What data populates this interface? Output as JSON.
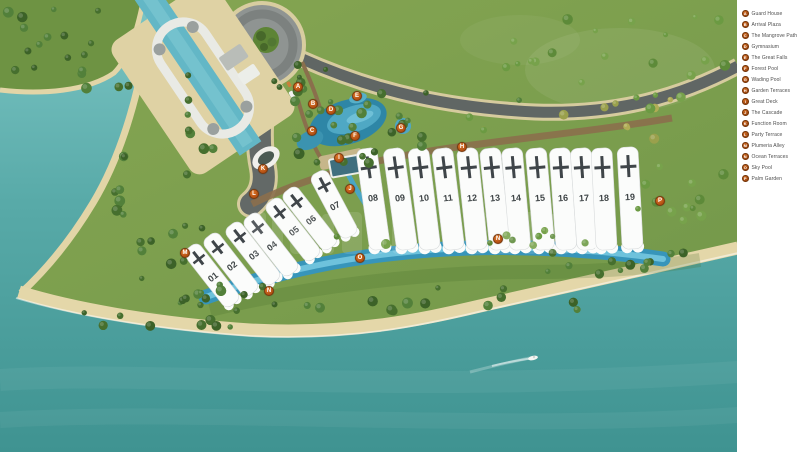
{
  "legend": {
    "badge_color": "#c05a1a",
    "items": [
      {
        "key": "A",
        "label": "Guard House"
      },
      {
        "key": "B",
        "label": "Arrival Plaza"
      },
      {
        "key": "C",
        "label": "The Mangrove Path"
      },
      {
        "key": "D",
        "label": "Gymnasium"
      },
      {
        "key": "E",
        "label": "The Great Falls"
      },
      {
        "key": "F",
        "label": "Forest Pool"
      },
      {
        "key": "G",
        "label": "Wading Pool"
      },
      {
        "key": "H",
        "label": "Garden Terraces"
      },
      {
        "key": "I",
        "label": "Great Deck"
      },
      {
        "key": "J",
        "label": "The Cascade"
      },
      {
        "key": "K",
        "label": "Function Room"
      },
      {
        "key": "L",
        "label": "Party Terrace"
      },
      {
        "key": "M",
        "label": "Plumeria Alley"
      },
      {
        "key": "N",
        "label": "Ocean Terraces"
      },
      {
        "key": "O",
        "label": "Sky Pool"
      },
      {
        "key": "P",
        "label": "Palm Garden"
      }
    ]
  },
  "map": {
    "marker_color": "#c05a1a",
    "markers": [
      {
        "key": "A",
        "x": 298,
        "y": 87
      },
      {
        "key": "B",
        "x": 313,
        "y": 104
      },
      {
        "key": "C",
        "x": 312,
        "y": 131
      },
      {
        "key": "D",
        "x": 331,
        "y": 110
      },
      {
        "key": "E",
        "x": 357,
        "y": 96
      },
      {
        "key": "F",
        "x": 355,
        "y": 136
      },
      {
        "key": "G",
        "x": 401,
        "y": 128
      },
      {
        "key": "H",
        "x": 462,
        "y": 147
      },
      {
        "key": "I",
        "x": 339,
        "y": 158
      },
      {
        "key": "J",
        "x": 350,
        "y": 189
      },
      {
        "key": "K",
        "x": 263,
        "y": 169
      },
      {
        "key": "L",
        "x": 254,
        "y": 194
      },
      {
        "key": "M",
        "x": 185,
        "y": 253
      },
      {
        "key": "N",
        "x": 269,
        "y": 291
      },
      {
        "key": "N",
        "x": 498,
        "y": 239
      },
      {
        "key": "O",
        "x": 360,
        "y": 258
      },
      {
        "key": "P",
        "x": 660,
        "y": 201
      }
    ],
    "buildings": [
      {
        "label": "01",
        "x": 213,
        "y": 277,
        "rot": -38,
        "row": "front"
      },
      {
        "label": "02",
        "x": 232,
        "y": 266,
        "rot": -38,
        "row": "front"
      },
      {
        "label": "03",
        "x": 254,
        "y": 255,
        "rot": -38,
        "row": "front"
      },
      {
        "label": "04",
        "x": 272,
        "y": 246,
        "rot": -38,
        "row": "front"
      },
      {
        "label": "05",
        "x": 294,
        "y": 231,
        "rot": -38,
        "row": "front"
      },
      {
        "label": "06",
        "x": 311,
        "y": 220,
        "rot": -38,
        "row": "front"
      },
      {
        "label": "07",
        "x": 335,
        "y": 206,
        "rot": -28,
        "row": "front"
      },
      {
        "label": "08",
        "x": 373,
        "y": 198,
        "rot": -8,
        "row": "back"
      },
      {
        "label": "09",
        "x": 400,
        "y": 198,
        "rot": -8,
        "row": "back"
      },
      {
        "label": "10",
        "x": 424,
        "y": 198,
        "rot": -7,
        "row": "back"
      },
      {
        "label": "11",
        "x": 448,
        "y": 198,
        "rot": -7,
        "row": "back"
      },
      {
        "label": "12",
        "x": 472,
        "y": 198,
        "rot": -6,
        "row": "back"
      },
      {
        "label": "13",
        "x": 495,
        "y": 198,
        "rot": -6,
        "row": "back"
      },
      {
        "label": "14",
        "x": 516,
        "y": 198,
        "rot": -5,
        "row": "back"
      },
      {
        "label": "15",
        "x": 540,
        "y": 198,
        "rot": -5,
        "row": "back"
      },
      {
        "label": "16",
        "x": 563,
        "y": 198,
        "rot": -4,
        "row": "back"
      },
      {
        "label": "17",
        "x": 584,
        "y": 198,
        "rot": -4,
        "row": "back"
      },
      {
        "label": "18",
        "x": 604,
        "y": 198,
        "rot": -3,
        "row": "back"
      },
      {
        "label": "19",
        "x": 630,
        "y": 197,
        "rot": -3,
        "row": "back"
      }
    ]
  }
}
